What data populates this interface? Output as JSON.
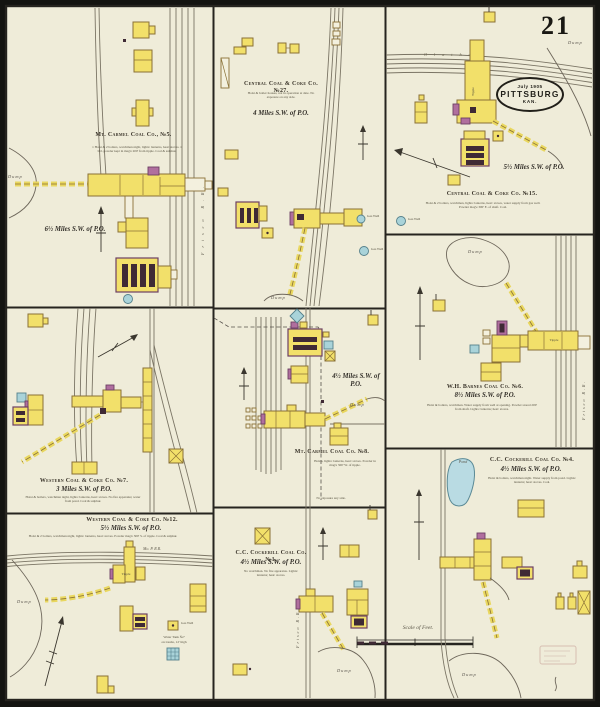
{
  "sheet": {
    "number": "21"
  },
  "stamp": {
    "date": "July 1905",
    "city": "PITTSBURG",
    "state": "KAN."
  },
  "scale_bar": {
    "label": "Scale of Feet."
  },
  "terrain": {
    "dump": "Dump",
    "pond": "Pond"
  },
  "railroads": {
    "mo_p": "Mo. P. R.R.",
    "frisco": "Frisco R.R.",
    "olathe": "Olathe"
  },
  "features": {
    "tipple": "Tipple",
    "gas_well": "Gas Well",
    "water_tank_line1": "Water Tank №7",
    "water_tank_line2": "on trestle, 12' high"
  },
  "panels": {
    "mt_carmel_5": {
      "title": "Mt. Carmel Coal Co., №5.",
      "note": "1 Hoist & 2 boilers, watchman night, lights: lanterns, heat: stoves. 1 bbl. powder kept in mag'e 200' from tipple. Coal & sulphur.",
      "distance": "6½ Miles S.W. of P.O."
    },
    "central_27": {
      "title": "Central Coal & Coke Co. №27.",
      "note": "Hoist & boiler houses, not in operation at date. No exposure on any side.",
      "distance": "4 Miles S.W. of P.O."
    },
    "central_15": {
      "title": "Central Coal & Coke Co. №15.",
      "note": "Hoist & 2 boilers, watchman, lights: lanterns, heat: stoves, water supply from gas well. Powder mag'e 300' E. of shaft. Coal.",
      "distance": "5½ Miles S.W. of P.O."
    },
    "western_7": {
      "title": "Western Coal & Coke Co. №7.",
      "note": "Hoist & boilers, watchman night, lights: lanterns, heat: stoves. No fire apparatus; water from pond. Coal & sulphur.",
      "distance": "3 Miles S.W. of P.O."
    },
    "mt_carmel_8": {
      "title": "Mt. Carmel Coal Co. №8.",
      "note": "Hoists, lights: lanterns, heat: stoves. Powder in mag'e 300' W. of tipple.",
      "note2": "No exposure any side.",
      "distance": "4½ Miles S.W. of P.O."
    },
    "barnes_6": {
      "title": "W.H. Barnes Coal Co. №6.",
      "note": "Hoist & boilers, watchman. Water supply from well at opening. Powder stored 200' from shaft. Lights: lanterns; heat: stoves.",
      "distance": "8½ Miles S.W. of P.O."
    },
    "western_12": {
      "title": "Western Coal & Coke Co. №12.",
      "note": "Hoist & 2 boilers, watchman night, lights: lanterns, heat: stoves. Powder mag'e 300' S. of tipple. Coal & sulphur.",
      "distance": "5½ Miles S.W. of P.O."
    },
    "cockerill_1": {
      "title": "C.C. Cockerill Coal Co. №1.",
      "note": "No watchman. No fire apparatus. Lights: lanterns; heat: stoves.",
      "distance": "4½ Miles S.W. of P.O."
    },
    "cockerill_4": {
      "title": "C.C. Cockerill Coal Co. №4.",
      "note": "Hoist & boilers, watchman night. Water supply from pond. Lights: lanterns; heat: stoves. Coal.",
      "distance": "4½ Miles S.W. of P.O."
    }
  }
}
